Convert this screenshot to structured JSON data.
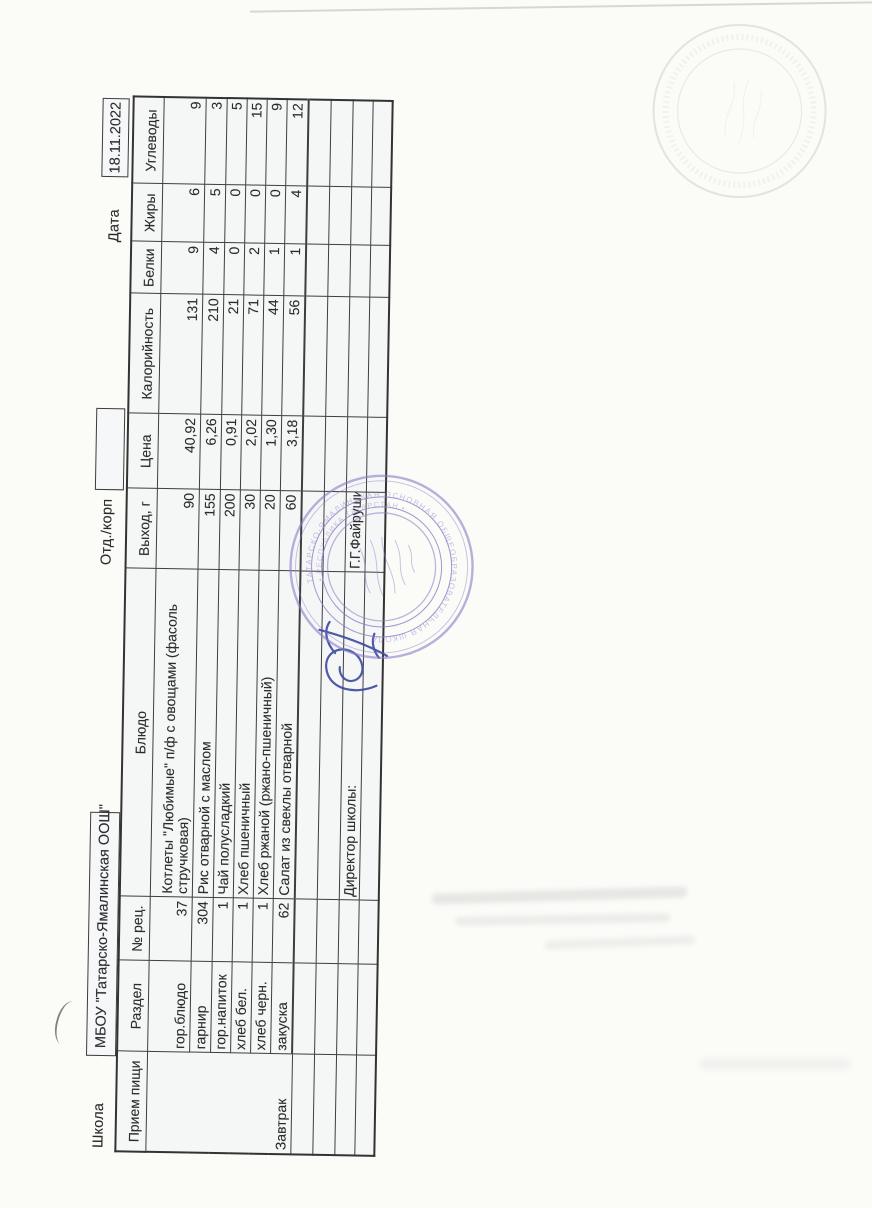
{
  "form": {
    "school_label": "Школа",
    "school_name": "МБОУ \"Татарско-Ямалинская ООШ\"",
    "dept_label": "Отд./корп",
    "date_label": "Дата",
    "date_value": "18.11.2022"
  },
  "table": {
    "headers": {
      "meal": "Прием пищи",
      "section": "Раздел",
      "recipe": "№ рец.",
      "dish": "Блюдо",
      "output": "Выход, г",
      "price": "Цена",
      "calories": "Калорийность",
      "protein": "Белки",
      "fat": "Жиры",
      "carbs": "Углеводы"
    },
    "meal_value": "Завтрак",
    "rows": [
      {
        "section": "гор.блюдо",
        "recipe": "37",
        "dish1": "Котлеты \"Любимые\" п/ф с овощами (фасоль",
        "dish2": "стручковая)",
        "output": "90",
        "price": "40,92",
        "calories": "131",
        "protein": "9",
        "fat": "6",
        "carbs": "9"
      },
      {
        "section": "гарнир",
        "recipe": "304",
        "dish1": "Рис отварной с маслом",
        "output": "155",
        "price": "6,26",
        "calories": "210",
        "protein": "4",
        "fat": "5",
        "carbs": "3"
      },
      {
        "section": "гор.напиток",
        "recipe": "1",
        "dish1": "Чай полусладкий",
        "output": "200",
        "price": "0,91",
        "calories": "21",
        "protein": "0",
        "fat": "0",
        "carbs": "5"
      },
      {
        "section": "хлеб бел.",
        "recipe": "1",
        "dish1": "Хлеб пшеничный",
        "output": "30",
        "price": "2,02",
        "calories": "71",
        "protein": "2",
        "fat": "0",
        "carbs": "15"
      },
      {
        "section": "хлеб черн.",
        "recipe": "1",
        "dish1": "Хлеб ржаной (ржано-пшеничный)",
        "output": "20",
        "price": "1,30",
        "calories": "44",
        "protein": "1",
        "fat": "0",
        "carbs": "9"
      },
      {
        "section": "закуска",
        "recipe": "62",
        "dish1": "Салат из свеклы отварной",
        "output": "60",
        "price": "3,18",
        "calories": "56",
        "protein": "1",
        "fat": "4",
        "carbs": "12"
      }
    ],
    "footer": {
      "director_label": "Директор школы:",
      "director_name": "Г.Г.Файрушина"
    }
  },
  "stamps": {
    "purple": {
      "color": "#8a7cc7",
      "ring_text": "ТАТАРСКО-ЯМАЛИНСКАЯ ОСНОВНАЯ ОБЩЕОБРАЗОВАТЕЛЬНАЯ ШКОЛА",
      "ring_text2": "• РЕСПУБЛИКА ТАТАРСТАН •"
    },
    "green": {
      "color": "#a9bfa4"
    },
    "signature_color": "#3a4aa1"
  }
}
